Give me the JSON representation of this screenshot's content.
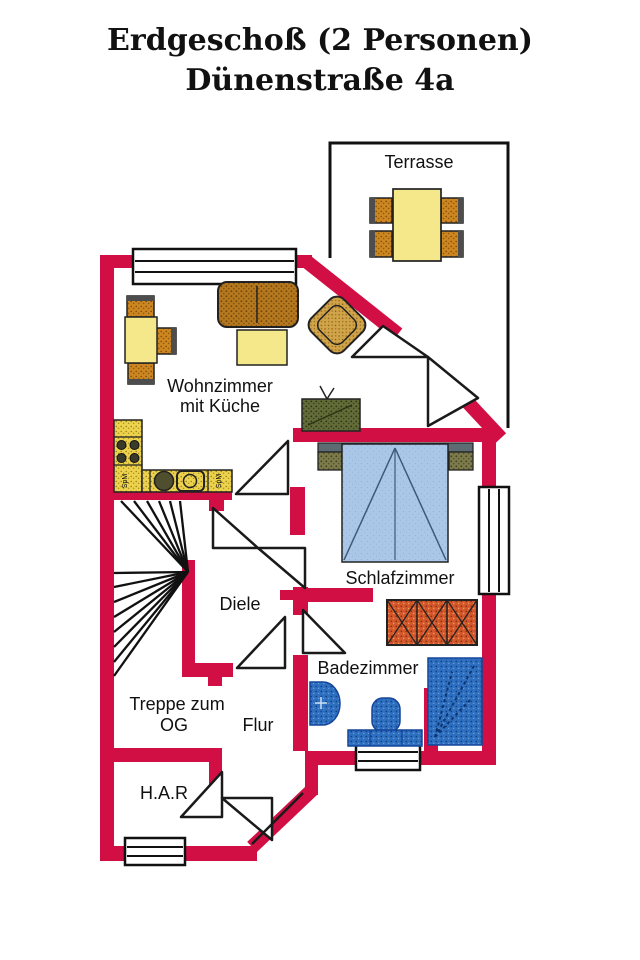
{
  "title": {
    "line1": "Erdgeschoß (2 Personen)",
    "line2": "Dünenstraße 4a"
  },
  "rooms": {
    "terrasse": "Terrasse",
    "wohnzimmer_line1": "Wohnzimmer",
    "wohnzimmer_line2": "mit Küche",
    "schlafzimmer": "Schlafzimmer",
    "diele": "Diele",
    "badezimmer": "Badezimmer",
    "treppe_line1": "Treppe zum",
    "treppe_line2": "OG",
    "flur": "Flur",
    "har": "H.A.R"
  },
  "kitchen_labels": {
    "left": "SpM",
    "right": "SpM"
  },
  "colors": {
    "wall": "#d10f44",
    "outline": "#111111",
    "bath_fixture": "#2e6fc0",
    "bed": "#aac7e8",
    "headboard": "#5d6b73",
    "radiator": "#d2572b",
    "kitchen_counter": "#edd24e",
    "chair_wood": "#cd8620",
    "sofa": "#b5781e",
    "armchair": "#d2a44a",
    "table_top": "#f5e88a",
    "tv": "#636c39",
    "nightstand": "#7d7b4b"
  }
}
